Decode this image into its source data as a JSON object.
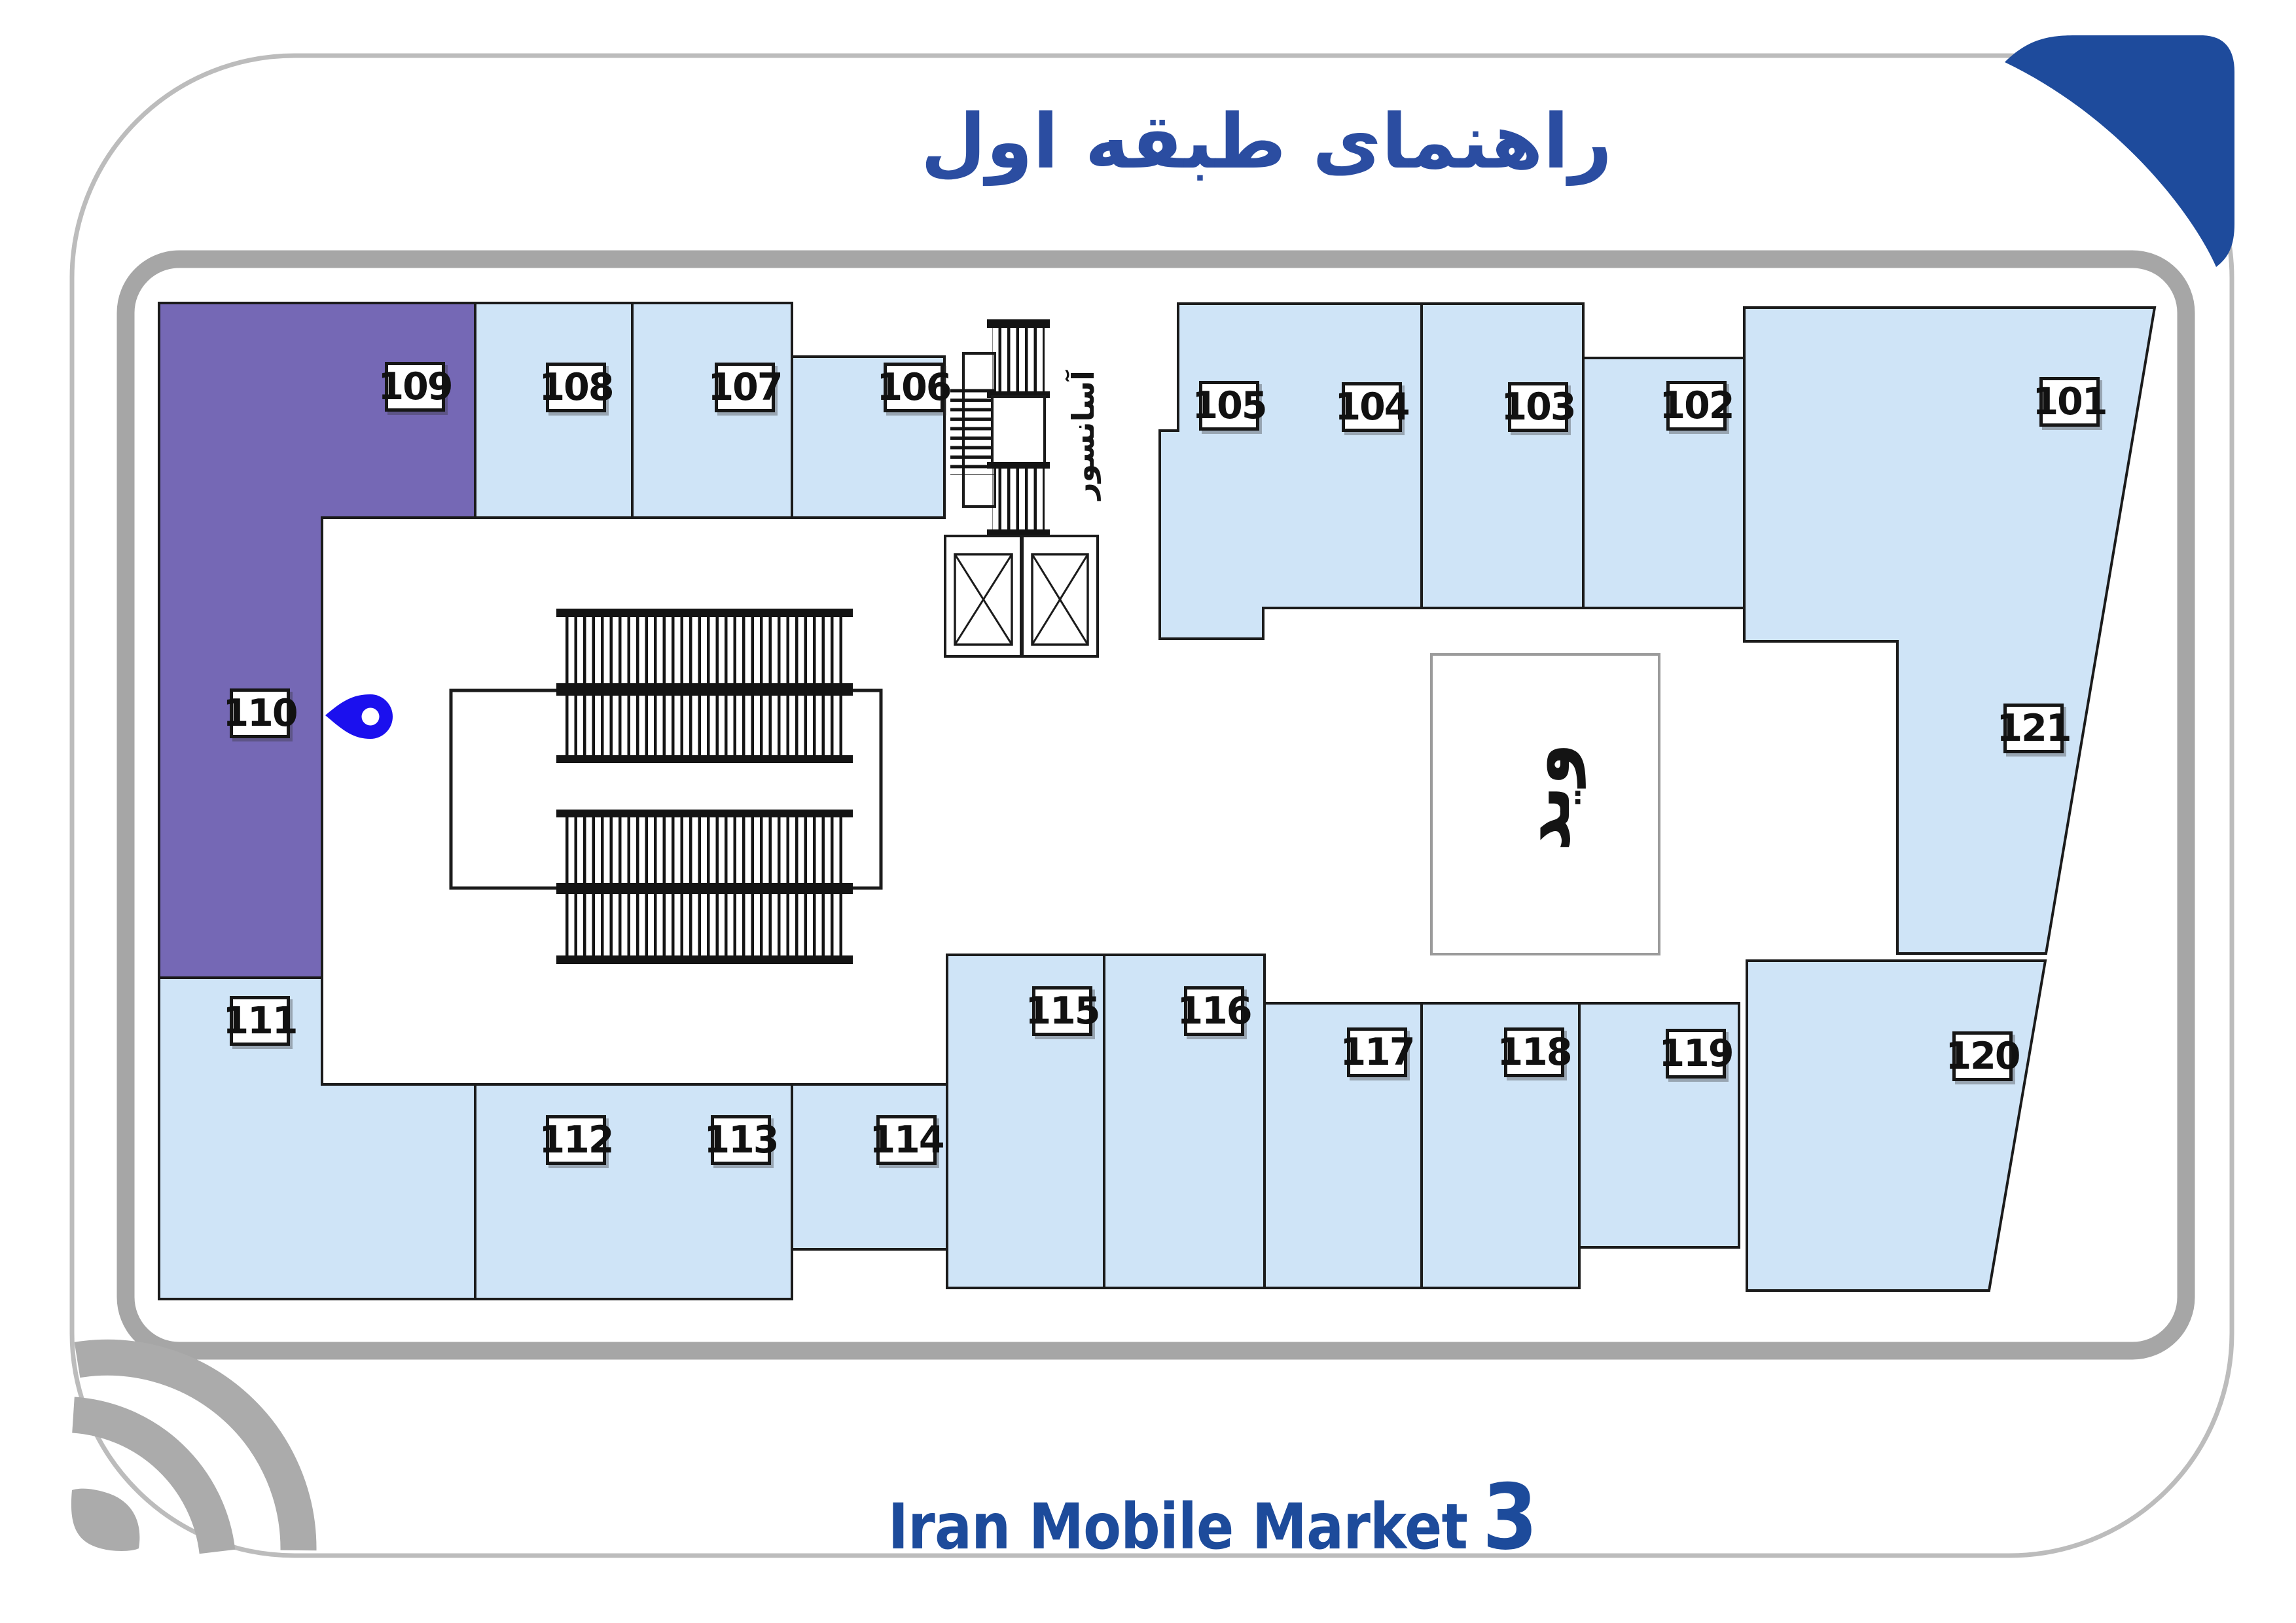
{
  "page": {
    "title": "راهنمای طبقه اول",
    "footer": {
      "brand": "Iran Mobile Market",
      "number": "3"
    }
  },
  "plan": {
    "elevator_label": "آسانسور",
    "void_label": "ويد",
    "highlighted_units": [
      "109",
      "110"
    ],
    "units": [
      {
        "number": "101"
      },
      {
        "number": "102"
      },
      {
        "number": "103"
      },
      {
        "number": "104"
      },
      {
        "number": "105"
      },
      {
        "number": "106"
      },
      {
        "number": "107"
      },
      {
        "number": "108"
      },
      {
        "number": "109"
      },
      {
        "number": "110"
      },
      {
        "number": "111"
      },
      {
        "number": "112"
      },
      {
        "number": "113"
      },
      {
        "number": "114"
      },
      {
        "number": "115"
      },
      {
        "number": "116"
      },
      {
        "number": "117"
      },
      {
        "number": "118"
      },
      {
        "number": "119"
      },
      {
        "number": "120"
      },
      {
        "number": "121"
      }
    ]
  },
  "colors": {
    "unit_fill": "#cfe4f7",
    "highlight_fill": "#7568b5",
    "title_blue": "#2b4da1",
    "brand_blue": "#1d4b9b",
    "frame_gray": "#a6a6a6",
    "decor_gray": "#ababab",
    "pin_blue": "#1b10ee"
  }
}
